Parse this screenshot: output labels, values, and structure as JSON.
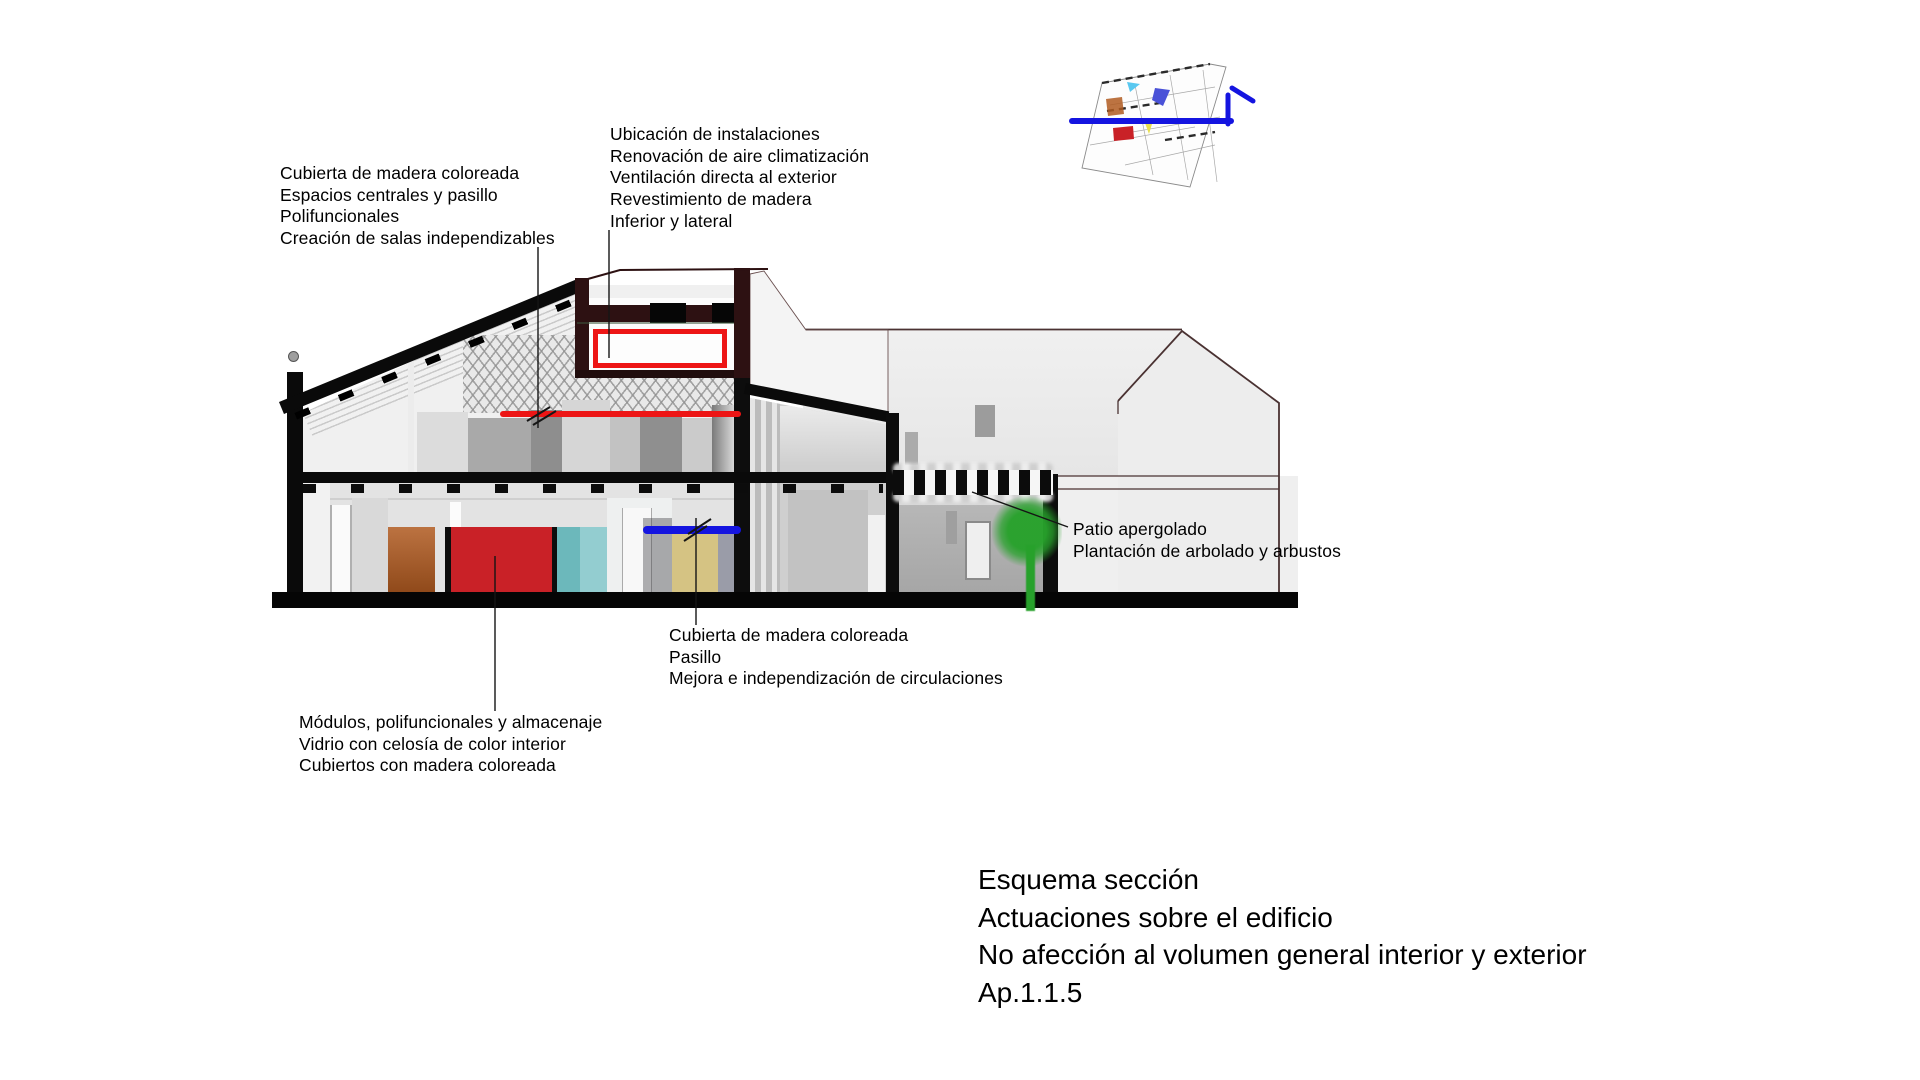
{
  "annotations": {
    "roof_left": {
      "lines": [
        "Cubierta de madera coloreada",
        "Espacios centrales y pasillo",
        "Polifuncionales",
        "Creación de salas independizables"
      ]
    },
    "installations": {
      "lines": [
        "Ubicación de instalaciones",
        "Renovación de aire climatización",
        "Ventilación directa al exterior",
        "Revestimiento de madera",
        "Inferior y lateral"
      ]
    },
    "patio": {
      "lines": [
        "Patio apergolado",
        "Plantación de arbolado y arbustos"
      ]
    },
    "corridor": {
      "lines": [
        "Cubierta de madera coloreada",
        "Pasillo",
        "Mejora e independización de circulaciones"
      ]
    },
    "modules": {
      "lines": [
        "Módulos, polifuncionales y almacenaje",
        "Vidrio con celosía de color interior",
        "Cubiertos con madera coloreada"
      ]
    }
  },
  "title_block": {
    "lines": [
      "Esquema sección",
      "Actuaciones sobre el edificio",
      "No afección al volumen general interior y exterior",
      "Ap.1.1.5"
    ]
  },
  "colors": {
    "highlight_red": "#ed1515",
    "highlight_blue": "#1414e0",
    "tree_green": "#27a12b",
    "module_orange": "#b05a20",
    "module_red": "#c92127",
    "module_teal": "#6cb8bb",
    "module_teal_light": "#93cdd0",
    "module_yellow": "#d5c383",
    "module_bluegray": "#9a9ca8",
    "frame_dark": "#2d1112",
    "structure_black": "#0a0a0a"
  }
}
